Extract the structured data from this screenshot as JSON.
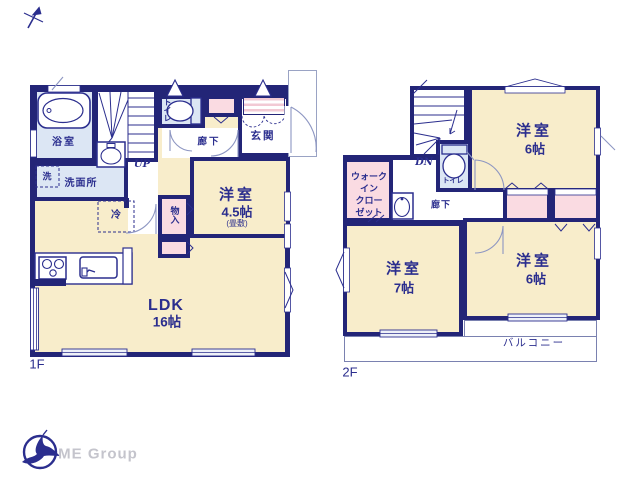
{
  "colors": {
    "wall": "#232577",
    "text": "#2b2e8e",
    "room_beige": "#f8edcb",
    "closet_pink": "#fadbe2",
    "wet_blue": "#dce6f4",
    "thin_line": "#8d96c2",
    "logo_gray": "#c4c4cc"
  },
  "f1": {
    "floor_label": "1F",
    "bath": "浴室",
    "laundry": "洗",
    "washroom": "洗面所",
    "stairs": "UP",
    "toilet": "トイレ",
    "hall": "廊下",
    "entrance": "玄関",
    "room45_name": "洋室",
    "room45_size": "4.5帖",
    "room45_note": "(畳敷)",
    "storage": "物入",
    "fridge": "冷",
    "ldk_name": "LDK",
    "ldk_size": "16帖"
  },
  "f2": {
    "floor_label": "2F",
    "stairs": "DN",
    "room6a_name": "洋室",
    "room6a_size": "6帖",
    "wic_l1": "ウォーク",
    "wic_l2": "イン",
    "wic_l3": "クロー",
    "wic_l4": "ゼット",
    "toilet": "トイレ",
    "hall": "廊下",
    "room7_name": "洋室",
    "room7_size": "7帖",
    "room6b_name": "洋室",
    "room6b_size": "6帖",
    "balcony": "バルコニー"
  },
  "footer": {
    "brand": "ME Group"
  }
}
